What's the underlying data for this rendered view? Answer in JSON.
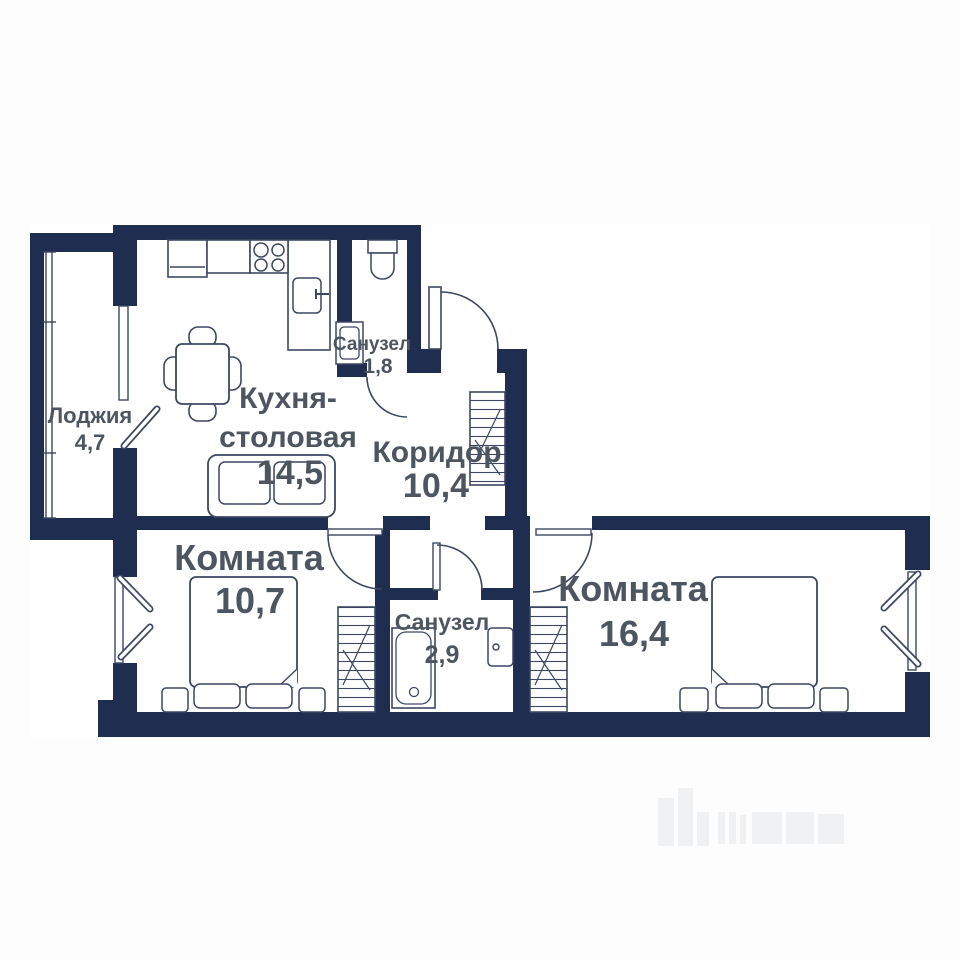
{
  "plan": {
    "type": "apartment-floor-plan",
    "rooms": {
      "loggia": {
        "label": "Лоджия",
        "area": "4,7"
      },
      "kitchen": {
        "label_line1": "Кухня-",
        "label_line2": "столовая",
        "area": "14,5"
      },
      "bathroom_top": {
        "label": "Санузел",
        "area": "1,8"
      },
      "corridor": {
        "label": "Коридор",
        "area": "10,4"
      },
      "bedroom_left": {
        "label": "Комната",
        "area": "10,7"
      },
      "bathroom_bottom": {
        "label": "Санузел",
        "area": "2,9"
      },
      "bedroom_right": {
        "label": "Комната",
        "area": "16,4"
      }
    },
    "colors": {
      "wall": "#1f2d50",
      "fixture_line": "#3d4763",
      "label_text": "#4d5660",
      "room_fill": "#ffffff",
      "background": "#fdfdfe"
    }
  }
}
